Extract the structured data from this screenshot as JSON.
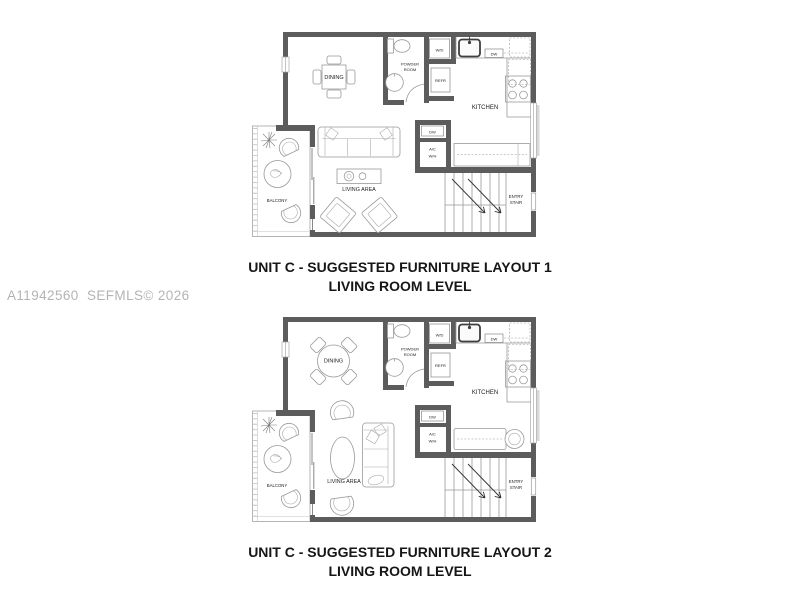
{
  "watermark": "A11942560  SEFMLS© 2026",
  "room_labels": {
    "dining": "DINING",
    "powder_line1": "POWDER",
    "powder_line2": "ROOM",
    "washer_dryer": "W/D",
    "dishwasher": "DW",
    "refrigerator": "REFR",
    "kitchen": "KITCHEN",
    "ac_line1": "A/C",
    "ac_line2": "W/H",
    "living_area": "LIVING AREA",
    "balcony": "BALCONY",
    "entry_line1": "ENTRY",
    "entry_line2": "STAIR"
  },
  "plans": [
    {
      "caption_line1": "UNIT C - SUGGESTED FURNITURE LAYOUT 1",
      "caption_line2": "LIVING ROOM LEVEL"
    },
    {
      "caption_line1": "UNIT C - SUGGESTED FURNITURE LAYOUT 2",
      "caption_line2": "LIVING ROOM LEVEL"
    }
  ],
  "colors": {
    "wall": "#5c5c5c",
    "thin_line": "#999999",
    "caption_text": "#161616",
    "watermark_text": "#b4b4b4"
  }
}
